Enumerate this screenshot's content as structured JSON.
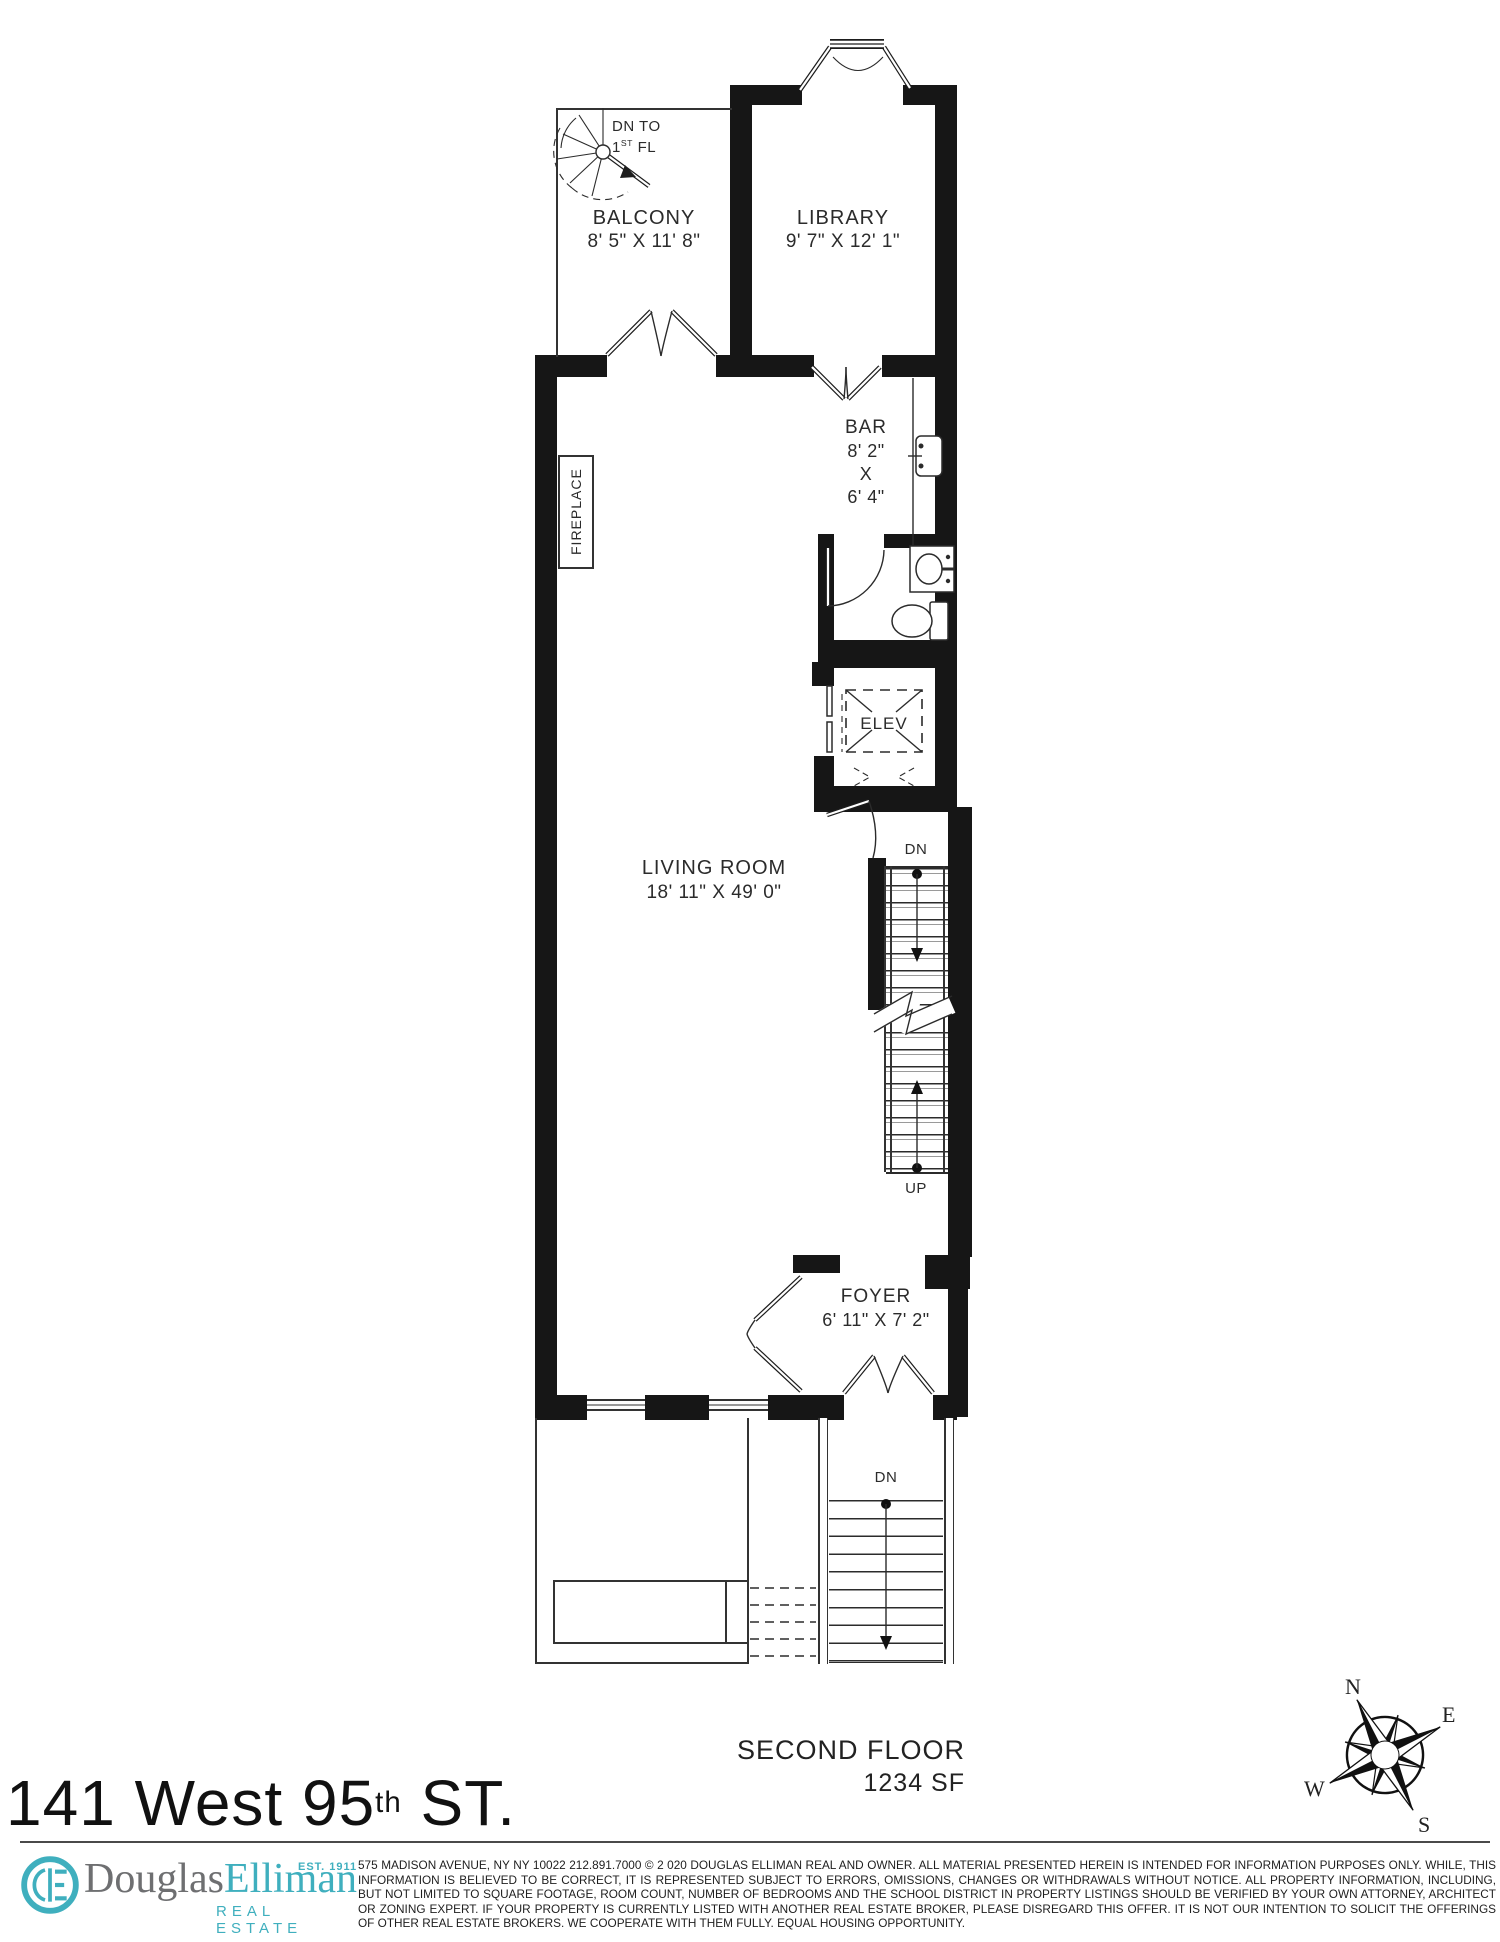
{
  "plan": {
    "balcony": {
      "name": "BALCONY",
      "dims": "8' 5\" X 11' 8\""
    },
    "balcony_stair": {
      "line1": "DN TO",
      "num": "1",
      "sup": "ST",
      "rest": " FL"
    },
    "library": {
      "name": "LIBRARY",
      "dims": "9' 7\" X 12' 1\""
    },
    "bar": {
      "name": "BAR",
      "dim1": "8' 2\"",
      "dim2": "X",
      "dim3": "6' 4\""
    },
    "fireplace": {
      "name": "FIREPLACE"
    },
    "elevator": {
      "name": "ELEV"
    },
    "living_room": {
      "name": "LIVING ROOM",
      "dims": "18' 11\" X 49' 0\""
    },
    "stairs": {
      "down": "DN",
      "up": "UP"
    },
    "foyer": {
      "name": "FOYER",
      "dims": "6' 11\" X 7' 2\""
    },
    "stoop": {
      "down": "DN"
    }
  },
  "floor_label": {
    "title": "SECOND FLOOR",
    "area": "1234 SF"
  },
  "compass": {
    "n": "N",
    "e": "E",
    "s": "S",
    "w": "W"
  },
  "footer": {
    "address_main": "141 West 95",
    "address_sup": "th",
    "address_rest": " ST.",
    "logo": {
      "monogram": "DE",
      "brand_gray": "Douglas",
      "brand_teal": "Elliman",
      "est": "EST. 1911",
      "tagline": "REAL ESTATE"
    },
    "disclaimer": "575 MADISON AVENUE, NY NY 10022 212.891.7000 © 2 020 DOUGLAS ELLIMAN REAL AND OWNER. ALL MATERIAL PRESENTED HEREIN IS INTENDED FOR INFORMATION PURPOSES ONLY. WHILE, THIS INFORMATION IS BELIEVED TO BE CORRECT, IT IS REPRESENTED SUBJECT TO ERRORS, OMISSIONS, CHANGES OR WITHDRAWALS WITHOUT NOTICE. ALL PROPERTY INFORMATION, INCLUDING, BUT NOT LIMITED TO SQUARE FOOTAGE, ROOM COUNT, NUMBER OF BEDROOMS AND THE SCHOOL DISTRICT IN PROPERTY LISTINGS SHOULD BE VERIFIED BY YOUR OWN ATTORNEY, ARCHITECT OR ZONING EXPERT. IF YOUR PROPERTY IS CURRENTLY LISTED WITH ANOTHER REAL ESTATE BROKER, PLEASE DISREGARD THIS OFFER. IT IS NOT OUR INTENTION TO SOLICIT THE OFFERINGS OF OTHER REAL ESTATE BROKERS. WE COOPERATE WITH THEM FULLY. EQUAL HOUSING OPPORTUNITY."
  },
  "colors": {
    "teal": "#3fafbe",
    "gray": "#6e6f71",
    "ink": "#161616"
  }
}
